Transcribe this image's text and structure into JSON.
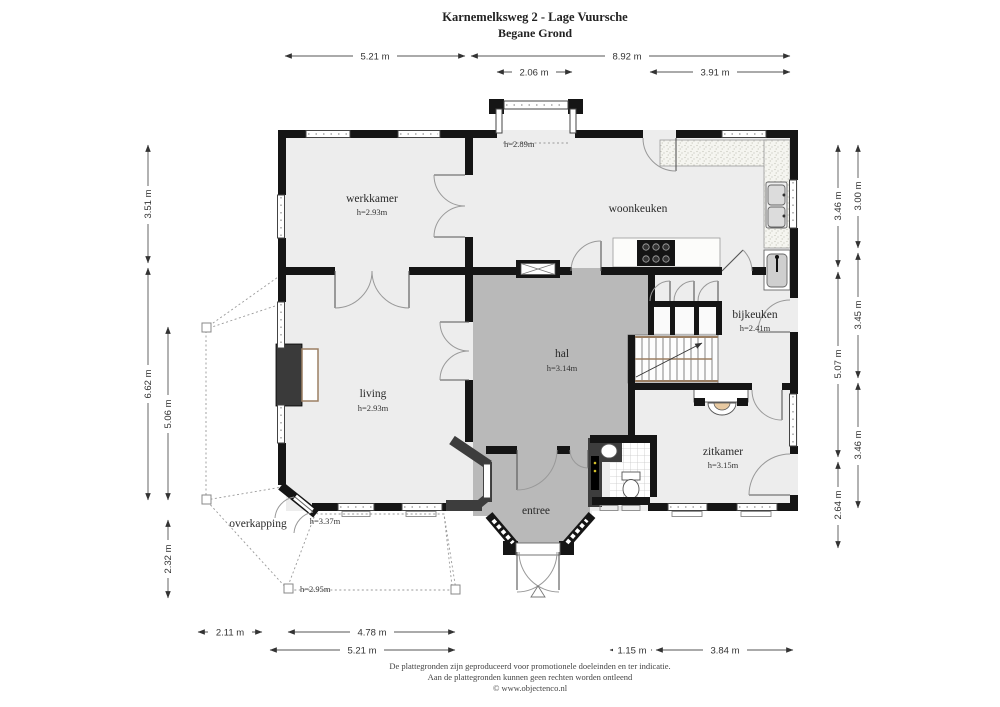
{
  "title": {
    "line1": "Karnemelksweg 2 - Lage Vuursche",
    "line2": "Begane Grond"
  },
  "rooms": {
    "werkkamer": {
      "name": "werkkamer",
      "height": "h=2.93m"
    },
    "woonkeuken": {
      "name": "woonkeuken"
    },
    "bijkeuken": {
      "name": "bijkeuken",
      "height": "h=2.41m"
    },
    "hal": {
      "name": "hal",
      "height": "h=3.14m"
    },
    "living": {
      "name": "living",
      "height": "h=2.93m"
    },
    "zitkamer": {
      "name": "zitkamer",
      "height": "h=3.15m"
    },
    "entree": {
      "name": "entree"
    },
    "overkapping": {
      "name": "overkapping"
    }
  },
  "annotations": {
    "bay_height": "h=2.89m",
    "porch_door_height": "h=3.37m",
    "porch_height": "h=2.95m"
  },
  "dimensions": {
    "top": [
      {
        "label": "5.21 m"
      },
      {
        "label": "8.92 m"
      },
      {
        "label": "2.06 m"
      },
      {
        "label": "3.91 m"
      }
    ],
    "right": [
      {
        "label": "3.46 m"
      },
      {
        "label": "5.07 m"
      },
      {
        "label": "2.64 m"
      },
      {
        "label": "3.00 m"
      },
      {
        "label": "3.45 m"
      },
      {
        "label": "3.46 m"
      }
    ],
    "left": [
      {
        "label": "3.51 m"
      },
      {
        "label": "6.62 m"
      },
      {
        "label": "5.06 m"
      },
      {
        "label": "2.32 m"
      }
    ],
    "bottom": [
      {
        "label": "2.11 m"
      },
      {
        "label": "4.78 m"
      },
      {
        "label": "5.21 m"
      },
      {
        "label": "1.15 m"
      },
      {
        "label": "3.84 m"
      }
    ]
  },
  "footer": {
    "line1": "De plattegronden zijn geproduceerd voor promotionele doeleinden en ter indicatie.",
    "line2": "Aan de plattegronden kunnen geen rechten worden ontleend",
    "line3": "© www.objectenco.nl"
  },
  "colors": {
    "wall": "#151515",
    "dark_wall": "#3d3d3d",
    "room_fill": "#ededed",
    "hall_fill": "#b9b9b9",
    "porch_fill": "#eaeaea",
    "wood_accent": "#9b7f63",
    "hearth": "#e7c9a1"
  }
}
